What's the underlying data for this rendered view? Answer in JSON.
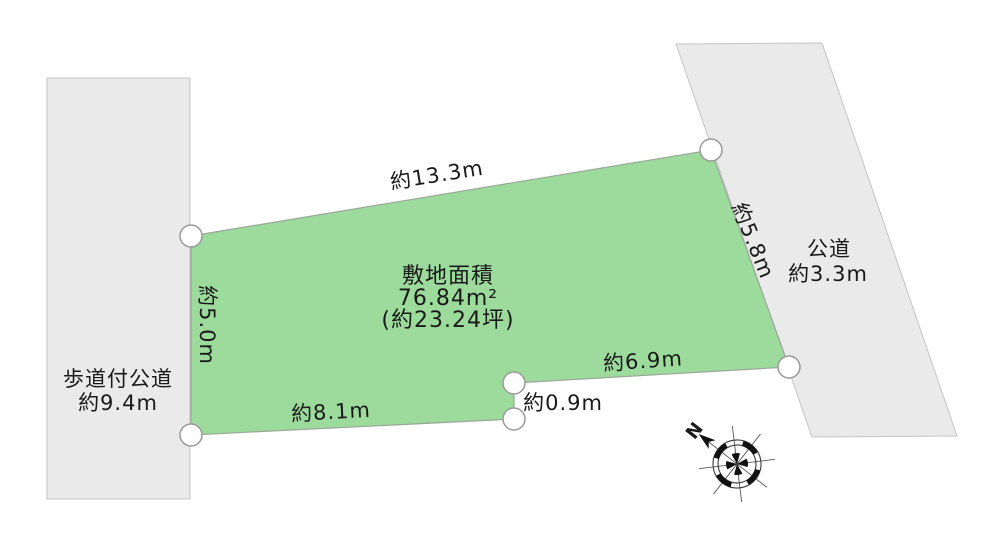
{
  "plot": {
    "area_line1": "敷地面積",
    "area_line2": "76.84m²",
    "area_line3": "(約23.24坪)",
    "dim_top": "約13.3m",
    "dim_left": "約5.0m",
    "dim_right": "約5.8m",
    "dim_lower_right": "約6.9m",
    "dim_step": "約0.9m",
    "dim_bottom": "約8.1m"
  },
  "roads": {
    "left_line1": "歩道付公道",
    "left_line2": "約9.4m",
    "right_line1": "公道",
    "right_line2": "約3.3m"
  },
  "compass": {
    "north_label": "N"
  },
  "colors": {
    "plot_fill": "#9cdb9c",
    "road_fill": "#eaeaea",
    "text": "#1a1a1a"
  }
}
